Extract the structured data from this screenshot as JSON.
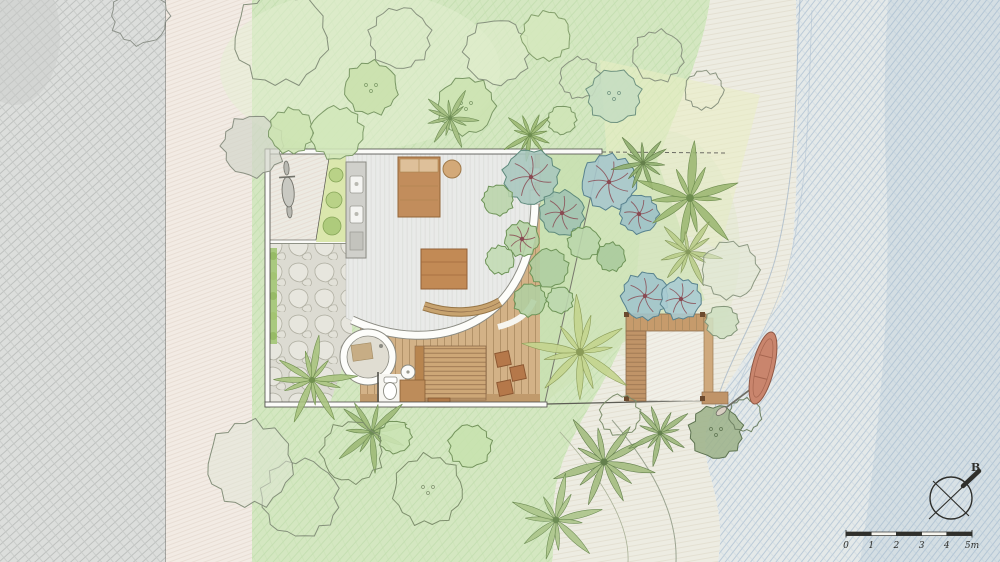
{
  "drawing": {
    "kind": "hand-drawn watercolor villa site plan",
    "features": [
      "road-area",
      "roadside-verge",
      "lawn-area",
      "dense-tropical-garden",
      "villa-building",
      "entry-court",
      "scooter",
      "kitchen-counter",
      "bedroom-floor",
      "bed",
      "ottoman",
      "coffee-table",
      "curved-bench",
      "wood-deck",
      "deck-stools",
      "stone-courtyard",
      "hedge",
      "outdoor-round-bathroom",
      "toilet",
      "wash-basin",
      "vanity",
      "slatted-spa-deck",
      "beach-pavilion",
      "canoe-with-paddle",
      "beach-sand",
      "sea-water",
      "compass-rose",
      "scale-bar"
    ]
  },
  "compass": {
    "label": "B"
  },
  "scale_bar": {
    "ticks": [
      "0",
      "1",
      "2",
      "3",
      "4",
      "5m"
    ]
  },
  "palette": {
    "paper": "#f7f6f1",
    "road_gray": "#dcdedc",
    "verge": "#f2ebe4",
    "lawn_green": "#d4e7c1",
    "garden_green": "#c8dfb0",
    "teal_tree": "#a7c6bd",
    "blue_tree": "#a6c6cd",
    "branch_red": "#8a4a52",
    "wood_deck": "#d3b287",
    "wood_dark": "#b07a49",
    "floor_gray": "#e9eae8",
    "stone": "#dcdbd2",
    "water_blue": "#a9bfd4",
    "sand": "#edece2",
    "canoe": "#c9856d",
    "ink": "#2f2f2b"
  },
  "plan": {
    "trees": [
      {
        "t": "outline",
        "x": 281,
        "y": 38,
        "r": 46,
        "s": "#85907b"
      },
      {
        "t": "outline",
        "x": 140,
        "y": 16,
        "r": 28,
        "s": "#8f948c"
      },
      {
        "t": "outline",
        "x": 253,
        "y": 146,
        "r": 30,
        "s": "#8b9183",
        "f": "#d3d6cb",
        "o": 0.7
      },
      {
        "t": "round",
        "x": 291,
        "y": 131,
        "r": 22,
        "f": "#cde4b2",
        "s": "#7f9c6a"
      },
      {
        "t": "round",
        "x": 337,
        "y": 133,
        "r": 26,
        "f": "#d2e7ba",
        "s": "#7f9c6a"
      },
      {
        "t": "outline",
        "x": 400,
        "y": 38,
        "r": 30,
        "s": "#8a9480"
      },
      {
        "t": "round",
        "x": 371,
        "y": 88,
        "r": 26,
        "f": "#c9e0ac",
        "s": "#7a9865",
        "d": 1
      },
      {
        "t": "round",
        "x": 466,
        "y": 106,
        "r": 28,
        "f": "#cce3b0",
        "s": "#7a9865",
        "d": 1
      },
      {
        "t": "outline",
        "x": 497,
        "y": 52,
        "r": 32,
        "s": "#87927e",
        "f": "#dfeccb",
        "o": 0.6
      },
      {
        "t": "round",
        "x": 546,
        "y": 36,
        "r": 24,
        "f": "#d5e8bd",
        "s": "#84a06c"
      },
      {
        "t": "outline",
        "x": 580,
        "y": 78,
        "r": 20,
        "s": "#8a9480"
      },
      {
        "t": "round",
        "x": 614,
        "y": 96,
        "r": 26,
        "f": "#c5ddc2",
        "s": "#6f9380",
        "d": 1
      },
      {
        "t": "outline",
        "x": 658,
        "y": 56,
        "r": 25,
        "s": "#8a9480"
      },
      {
        "t": "outline",
        "x": 704,
        "y": 90,
        "r": 19,
        "s": "#8a9480"
      },
      {
        "t": "round",
        "x": 562,
        "y": 120,
        "r": 14,
        "f": "#cfe5b6",
        "s": "#7a9865"
      },
      {
        "t": "palm",
        "x": 450,
        "y": 118,
        "sc": 0.85,
        "rot": 0,
        "f": "#a3bd80",
        "s": "#6d8c54"
      },
      {
        "t": "palm",
        "x": 530,
        "y": 135,
        "sc": 0.8,
        "rot": 25,
        "f": "#9cb873",
        "s": "#6d8c4e"
      },
      {
        "t": "round",
        "x": 531,
        "y": 177,
        "r": 27,
        "f": "#a7c6bd",
        "s": "#5e8a7c",
        "b": 1
      },
      {
        "t": "round",
        "x": 562,
        "y": 213,
        "r": 22,
        "f": "#9fc2b2",
        "s": "#5e8a7c",
        "b": 1
      },
      {
        "t": "round",
        "x": 609,
        "y": 182,
        "r": 27,
        "f": "#a6c6cd",
        "s": "#58828e",
        "b": 1
      },
      {
        "t": "round",
        "x": 639,
        "y": 214,
        "r": 19,
        "f": "#9cc0c7",
        "s": "#58828e",
        "b": 1
      },
      {
        "t": "round",
        "x": 498,
        "y": 200,
        "r": 15,
        "f": "#b9d4aa",
        "s": "#6e9458"
      },
      {
        "t": "round",
        "x": 522,
        "y": 239,
        "r": 17,
        "f": "#b4d1a4",
        "s": "#6e9458",
        "b": 1
      },
      {
        "t": "round",
        "x": 549,
        "y": 268,
        "r": 19,
        "f": "#aecda0",
        "s": "#6e9458"
      },
      {
        "t": "round",
        "x": 584,
        "y": 243,
        "r": 16,
        "f": "#bad6ab",
        "s": "#6e9458"
      },
      {
        "t": "round",
        "x": 611,
        "y": 257,
        "r": 14,
        "f": "#a8c99c",
        "s": "#6e9458"
      },
      {
        "t": "round",
        "x": 530,
        "y": 300,
        "r": 16,
        "f": "#b0cfa2",
        "s": "#6e9458"
      },
      {
        "t": "round",
        "x": 560,
        "y": 300,
        "r": 13,
        "f": "#bcd7ae",
        "s": "#6e9458"
      },
      {
        "t": "round",
        "x": 500,
        "y": 260,
        "r": 14,
        "f": "#c2dbb3",
        "s": "#6e9458"
      },
      {
        "t": "palm",
        "x": 643,
        "y": 163,
        "sc": 0.9,
        "rot": 40,
        "f": "#8fae6f",
        "s": "#647f4a"
      },
      {
        "t": "palm",
        "x": 690,
        "y": 198,
        "sc": 1.55,
        "rot": 10,
        "f": "#9cb873",
        "s": "#6d8c4e"
      },
      {
        "t": "palm",
        "x": 688,
        "y": 252,
        "sc": 1.0,
        "rot": -30,
        "f": "#b9cc8a",
        "s": "#84985a"
      },
      {
        "t": "outline",
        "x": 730,
        "y": 270,
        "r": 28,
        "s": "#8e9a84",
        "f": "#dde6d2",
        "o": 0.5
      },
      {
        "t": "round",
        "x": 722,
        "y": 322,
        "r": 16,
        "f": "#cfdfc2",
        "s": "#84967a"
      },
      {
        "t": "round",
        "x": 645,
        "y": 296,
        "r": 23,
        "f": "#9fc4cb",
        "s": "#58828e",
        "b": 1
      },
      {
        "t": "round",
        "x": 681,
        "y": 299,
        "r": 20,
        "f": "#a9cbd2",
        "s": "#58828e",
        "b": 1
      },
      {
        "t": "palm",
        "x": 580,
        "y": 352,
        "sc": 1.6,
        "rot": 0,
        "f": "#c3d48e",
        "s": "#8a9b57"
      },
      {
        "t": "palm",
        "x": 312,
        "y": 380,
        "sc": 1.25,
        "rot": 20,
        "f": "#a9c37e",
        "s": "#71904f"
      },
      {
        "t": "palm",
        "x": 372,
        "y": 432,
        "sc": 1.15,
        "rot": -15,
        "f": "#9db977",
        "s": "#6d8c54"
      },
      {
        "t": "round",
        "x": 395,
        "y": 437,
        "r": 16,
        "f": "#cbe4b4",
        "s": "#74945c"
      },
      {
        "t": "outline",
        "x": 352,
        "y": 452,
        "r": 30,
        "s": "#7e8f6d"
      },
      {
        "t": "outline",
        "x": 428,
        "y": 490,
        "r": 34,
        "s": "#7e8f6d",
        "d": 1
      },
      {
        "t": "round",
        "x": 470,
        "y": 446,
        "r": 21,
        "f": "#c7e2ae",
        "s": "#74945c"
      },
      {
        "t": "outline",
        "x": 300,
        "y": 498,
        "r": 38,
        "s": "#85907b"
      },
      {
        "t": "outline",
        "x": 250,
        "y": 464,
        "r": 42,
        "s": "#85907b",
        "f": "#dfe5d5",
        "o": 0.5
      },
      {
        "t": "palm",
        "x": 604,
        "y": 462,
        "sc": 1.45,
        "rot": 5,
        "f": "#a3bd80",
        "s": "#64804d"
      },
      {
        "t": "palm",
        "x": 556,
        "y": 520,
        "sc": 1.3,
        "rot": -20,
        "f": "#abc489",
        "s": "#6d8c54"
      },
      {
        "t": "palm",
        "x": 660,
        "y": 433,
        "sc": 0.95,
        "rot": 30,
        "f": "#9cb77b",
        "s": "#64804d"
      },
      {
        "t": "outline",
        "x": 620,
        "y": 415,
        "r": 20,
        "s": "#7e8f6d"
      },
      {
        "t": "round",
        "x": 716,
        "y": 432,
        "r": 26,
        "f": "#9eb38b",
        "s": "#5d7350",
        "d": 1
      },
      {
        "t": "outline",
        "x": 745,
        "y": 415,
        "r": 16,
        "s": "#6f8263"
      }
    ]
  }
}
